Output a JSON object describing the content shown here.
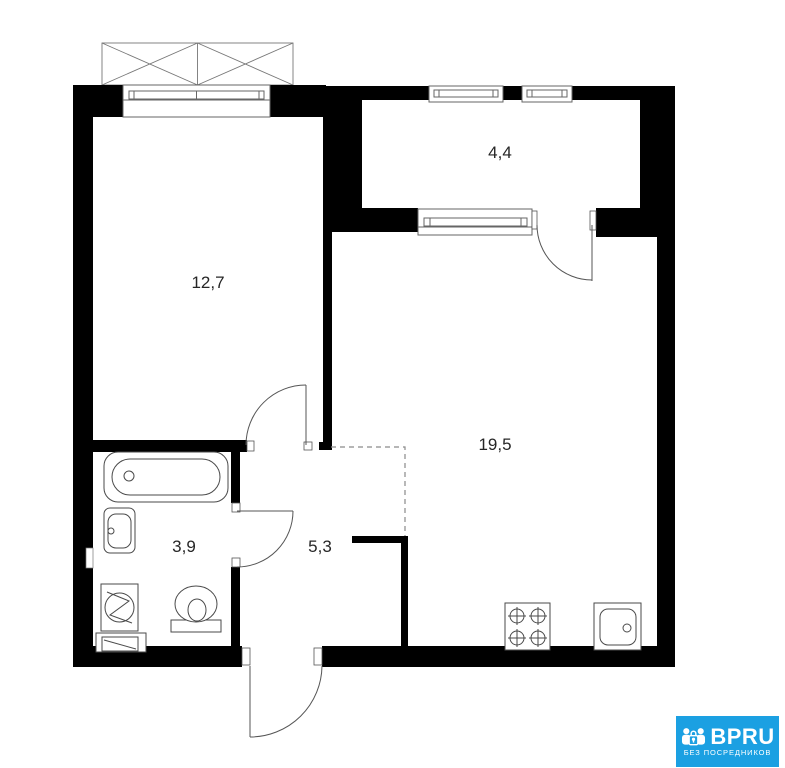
{
  "floor_plan": {
    "background_color": "#ffffff",
    "wall_color": "#000000",
    "line_color": "#555555",
    "rooms": [
      {
        "id": "room-1",
        "area_label": "12,7"
      },
      {
        "id": "room-2",
        "area_label": "4,4"
      },
      {
        "id": "room-3",
        "area_label": "19,5"
      },
      {
        "id": "room-4",
        "area_label": "3,9"
      },
      {
        "id": "room-5",
        "area_label": "5,3"
      }
    ],
    "fixtures": [
      "bathtub",
      "washbasin",
      "toilet",
      "washing-machine",
      "vent-box",
      "stove",
      "kitchen-sink"
    ]
  },
  "watermark": {
    "brand": "BPRU",
    "tagline": "БЕЗ ПОСРЕДНИКОВ",
    "background_color": "#1BA0E2",
    "text_color": "#ffffff"
  }
}
